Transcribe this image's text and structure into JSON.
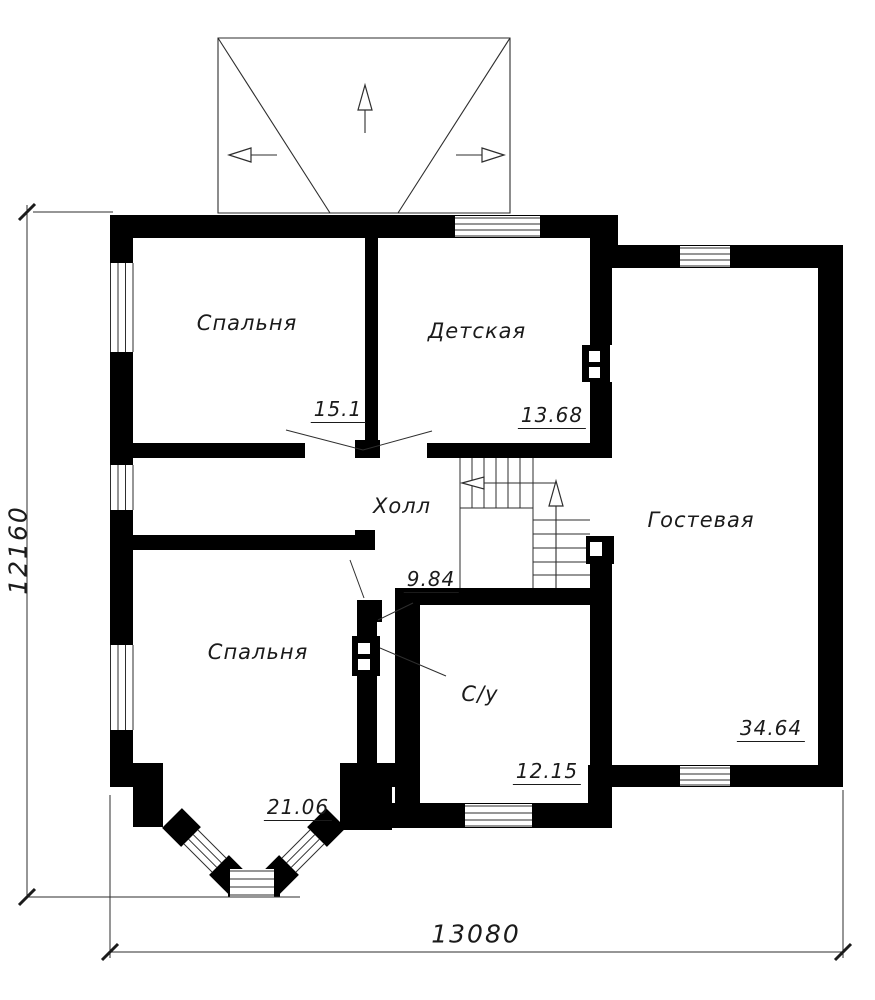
{
  "plan": {
    "rooms": [
      {
        "label": "Спальня",
        "area": "15.1"
      },
      {
        "label": "Детская",
        "area": "13.68"
      },
      {
        "label": "Холл",
        "area": "9.84"
      },
      {
        "label": "Гостевая",
        "area": "34.64"
      },
      {
        "label": "Спальня",
        "area": "21.06"
      },
      {
        "label": "С/у",
        "area": "12.15"
      }
    ],
    "overall_dimensions": {
      "vertical": "12160",
      "horizontal": "13080"
    },
    "colors": {
      "walls": "#000000",
      "lines": "#2e2e2e",
      "text": "#1b1b1b",
      "background": "#ffffff"
    }
  }
}
